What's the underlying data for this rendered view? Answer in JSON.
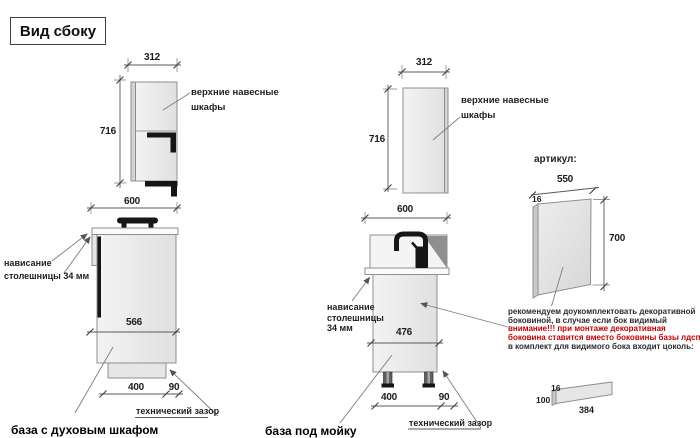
{
  "title": "Вид сбоку",
  "colors": {
    "warning_red": "#c00000",
    "line_gray": "#8f8f8f",
    "accent_black": "#161616"
  },
  "left_unit": {
    "upper": {
      "width": "312",
      "height": "716",
      "label": {
        "line1": "верхние навесные",
        "line2": "шкафы"
      }
    },
    "base": {
      "width": "600",
      "inner_height": "566",
      "plinth_depth": "400",
      "gap": "90",
      "overhang": {
        "line1": "нависание",
        "line2": "столешницы 34 мм"
      },
      "gap_note": "технический зазор",
      "caption": "база с духовым шкафом"
    }
  },
  "middle_unit": {
    "upper": {
      "width": "312",
      "height": "716",
      "label": {
        "line1": "верхние навесные",
        "line2": "шкафы"
      }
    },
    "base": {
      "width": "600",
      "inner_height": "476",
      "plinth_depth": "400",
      "gap": "90",
      "overhang": {
        "line1": "нависание",
        "line2": "столешницы",
        "line3": "34 мм"
      },
      "gap_note": "технический зазор",
      "caption": "база под мойку"
    }
  },
  "side_panel": {
    "article_label": "артикул:",
    "width": "550",
    "thickness": "16",
    "height": "700",
    "note": {
      "line1": "рекомендуем доукомплектовать декоративной",
      "line2": "боковиной, в случае если бок видимый",
      "line3": "внимание!!! при монтаже декоративная",
      "line4": "боковина ставится вместо боковины базы лдсп",
      "line5": "в комплект для видимого бока входит цоколь:"
    },
    "plinth": {
      "thickness": "16",
      "height": "100",
      "length": "384"
    }
  }
}
